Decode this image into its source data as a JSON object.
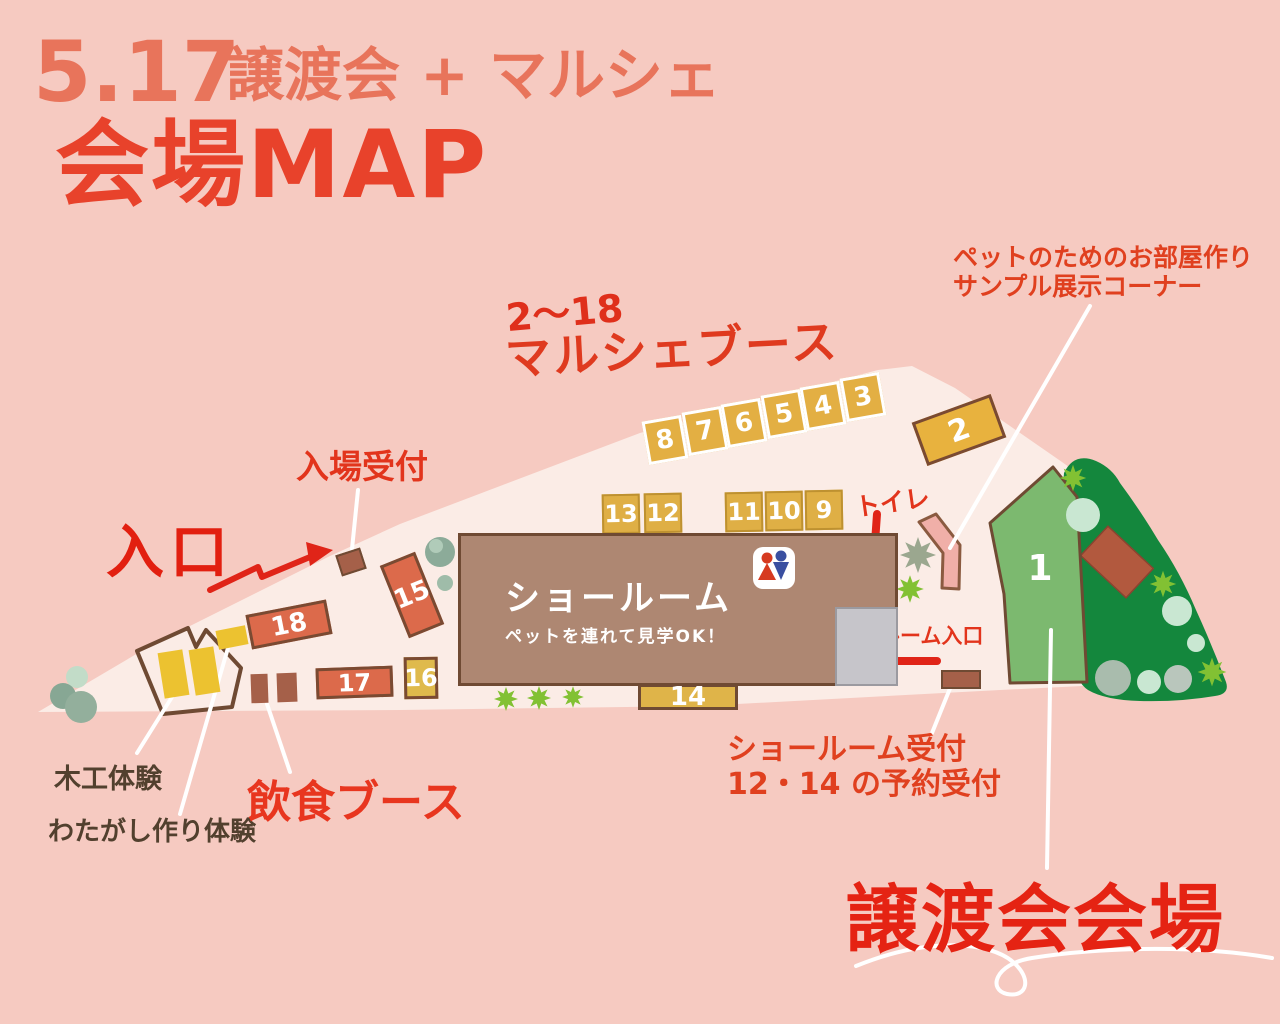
{
  "poster": {
    "date": "5.17",
    "event": "譲渡会 + マルシェ",
    "heading": "会場MAP"
  },
  "labels": {
    "marche_range": "2〜18",
    "marche_booths": "マルシェブース",
    "entrance": "入口",
    "entrance_reception": "入場受付",
    "toilet": "トイレ",
    "pet_room_sample_line1": "ペットのためのお部屋作り",
    "pet_room_sample_line2": "サンプル展示コーナー",
    "showroom": "ショールーム",
    "showroom_note": "ペットを連れて見学OK！",
    "showroom_entrance": "ショールーム入口",
    "showroom_reception_line1": "ショールーム受付",
    "showroom_reception_line2": "12・14 の予約受付",
    "woodworking": "木工体験",
    "cotton_candy": "わたがし作り体験",
    "food_booths": "飲食ブース",
    "adoption_venue": "譲渡会会場"
  },
  "booths": {
    "marche_row_top": [
      "8",
      "7",
      "6",
      "5",
      "4",
      "3"
    ],
    "booth_2": "2",
    "row_13_12": [
      "13",
      "12"
    ],
    "row_11_10_9": [
      "11",
      "10",
      "9"
    ],
    "booth_14": "14",
    "booth_15": "15",
    "booth_16": "16",
    "booth_17": "17",
    "booth_18": "18",
    "adoption_area": "1"
  },
  "icons": {
    "restroom": "male-female-restroom"
  },
  "colors": {
    "background": "#F6CAC1",
    "map_ground": "#FBECE6",
    "title_coral": "#E8745B",
    "title_red": "#E8422B",
    "label_red": "#E2341C",
    "booth_yellow": "#DFAF45",
    "booth_orange": "#E8B23E",
    "booth_terracotta": "#DC6A4B",
    "booth_brown": "#A56049",
    "showroom_brown": "#AE8772",
    "adoption_green": "#7CB96F",
    "forest_green": "#14873D",
    "bush_lime": "#82C133",
    "annotation_brown": "#52402E"
  }
}
